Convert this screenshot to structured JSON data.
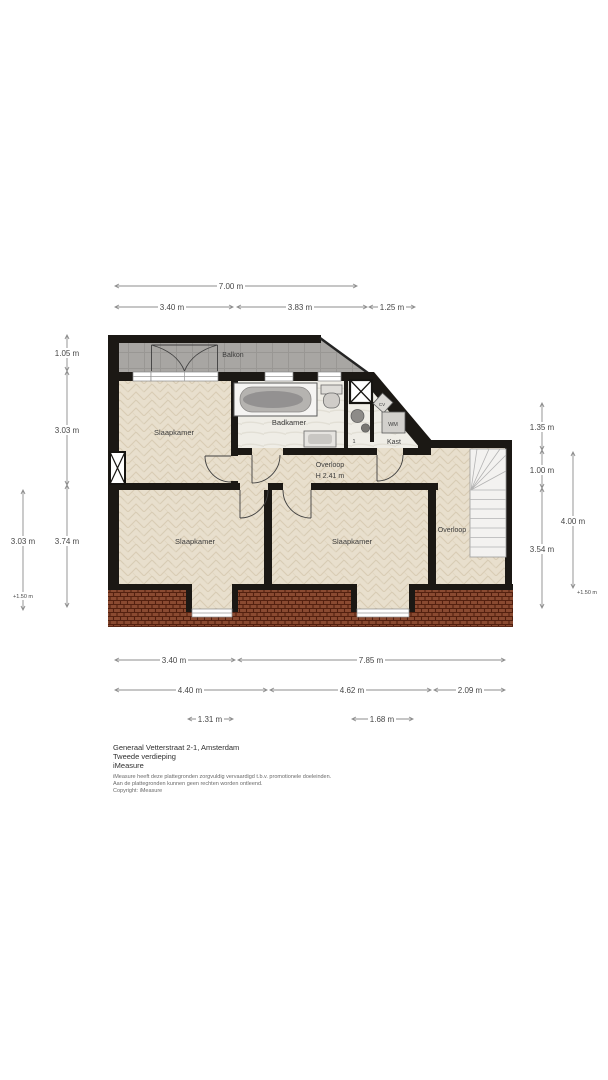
{
  "title_block": {
    "address": "Generaal Vetterstraat 2-1, Amsterdam",
    "floor": "Tweede verdieping",
    "company": "iMeasure",
    "disclaimer1": "iMeasure heeft deze plattegronden zorgvuldig vervaardigd t.b.v. promotionele doeleinden.",
    "disclaimer2": "Aan de plattegronden kunnen geen rechten worden ontleend.",
    "disclaimer3": "Copyright: iMeasure"
  },
  "rooms": {
    "balkon": "Balkon",
    "slaapkamer_top": "Slaapkamer",
    "badkamer": "Badkamer",
    "overloop": "Overloop",
    "overloop_height": "H 2.41 m",
    "kast": "Kast",
    "slaapkamer_left": "Slaapkamer",
    "slaapkamer_mid": "Slaapkamer",
    "overloop_right": "Overloop"
  },
  "fixtures": {
    "washing_machine": "WM",
    "boiler": "CV",
    "door_mark": "1"
  },
  "dimensions": {
    "top_total": "7.00 m",
    "top_segments": [
      "3.40 m",
      "3.83 m",
      "1.25 m"
    ],
    "left_inner": [
      "1.05 m",
      "3.03 m",
      "3.74 m"
    ],
    "left_outer": [
      "3.03 m",
      "+1.50 m"
    ],
    "right_inner": [
      "1.35 m",
      "1.00 m",
      "3.54 m"
    ],
    "right_outer": [
      "4.00 m",
      "+1.50 m"
    ],
    "bottom_row1": [
      "3.40 m",
      "7.85 m"
    ],
    "bottom_row2": [
      "4.40 m",
      "4.62 m",
      "2.09 m"
    ],
    "bottom_row3": [
      "1.31 m",
      "1.68 m"
    ]
  },
  "colors": {
    "wall": "#1b1814",
    "parquet": "#e8dfcd",
    "tile": "#efede6",
    "balcony": "#a8a6a3",
    "roof": "#8a4a31",
    "dimension_line": "#8c8c8c",
    "label_text": "#3c3c3c"
  }
}
